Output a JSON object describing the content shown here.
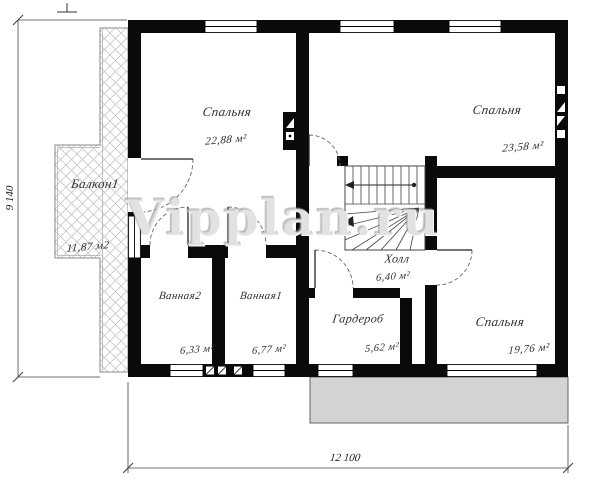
{
  "watermark": "Vipplan.ru",
  "dimensions": {
    "bottom": "12 100",
    "left": "9 140"
  },
  "rooms": [
    {
      "id": "bedroom-top-left",
      "name": "Спальня",
      "area": "22,88 м²"
    },
    {
      "id": "bedroom-top-right",
      "name": "Спальня",
      "area": "23,58 м²"
    },
    {
      "id": "balcony",
      "name": "Балкон1",
      "area": "11,87 м2"
    },
    {
      "id": "hall",
      "name": "Холл",
      "area": "6,40 м²"
    },
    {
      "id": "bathroom-2",
      "name": "Ванная2",
      "area": "6,33 м²"
    },
    {
      "id": "bathroom-1",
      "name": "Ванная1",
      "area": "6,77 м²"
    },
    {
      "id": "wardrobe",
      "name": "Гардероб",
      "area": "5,62 м²"
    },
    {
      "id": "bedroom-bottom-right",
      "name": "Спальня",
      "area": "19,76 м²"
    }
  ]
}
